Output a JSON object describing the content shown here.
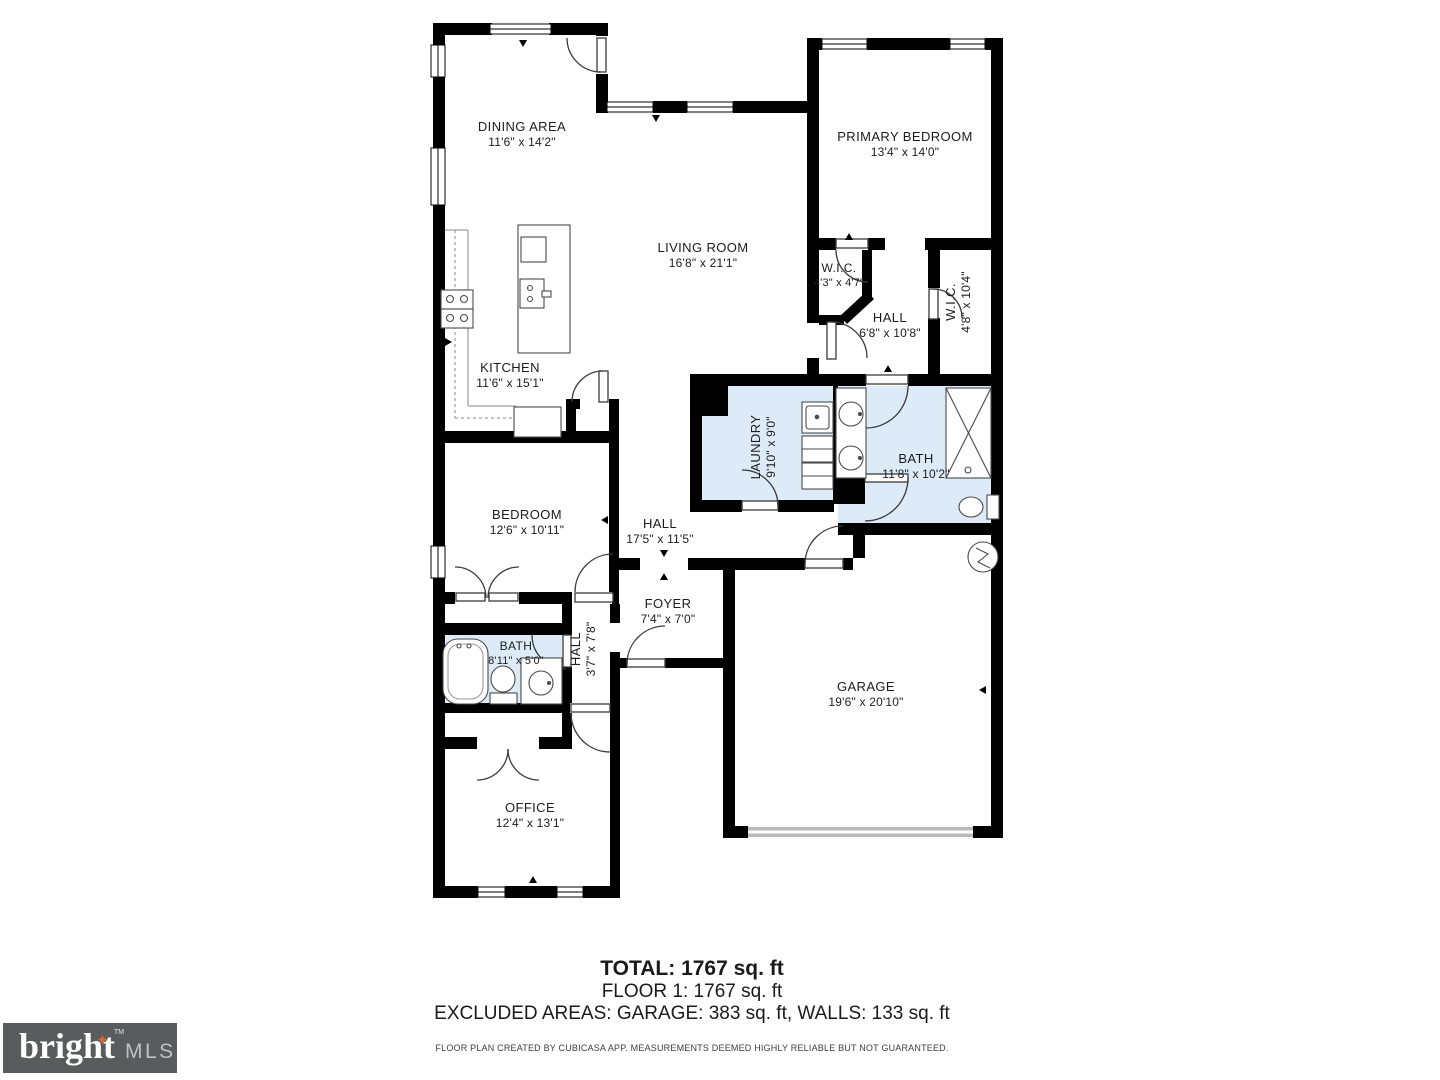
{
  "rooms": {
    "dining": {
      "name": "DINING AREA",
      "dims": "11'6\" x 14'2\""
    },
    "primary": {
      "name": "PRIMARY BEDROOM",
      "dims": "13'4\" x 14'0\""
    },
    "living": {
      "name": "LIVING ROOM",
      "dims": "16'8\" x 21'1\""
    },
    "wic1": {
      "name": "W.I.C.",
      "dims": "4'3\" x 4'7\""
    },
    "hall1": {
      "name": "HALL",
      "dims": "6'8\" x 10'8\""
    },
    "wic2": {
      "name": "W.I.C.",
      "dims": "4'8\" x 10'4\""
    },
    "kitchen": {
      "name": "KITCHEN",
      "dims": "11'6\" x 15'1\""
    },
    "laundry": {
      "name": "LAUNDRY",
      "dims": "9'10\" x 9'0\""
    },
    "bath1": {
      "name": "BATH",
      "dims": "11'8\" x 10'2\""
    },
    "bedroom": {
      "name": "BEDROOM",
      "dims": "12'6\" x 10'11\""
    },
    "hall2": {
      "name": "HALL",
      "dims": "17'5\" x 11'5\""
    },
    "foyer": {
      "name": "FOYER",
      "dims": "7'4\" x 7'0\""
    },
    "bath2": {
      "name": "BATH",
      "dims": "8'11\" x 5'0\""
    },
    "hall3": {
      "name": "HALL",
      "dims": "3'7\" x 7'8\""
    },
    "garage": {
      "name": "GARAGE",
      "dims": "19'6\" x 20'10\""
    },
    "office": {
      "name": "OFFICE",
      "dims": "12'4\" x 13'1\""
    }
  },
  "summary": {
    "total": "TOTAL: 1767 sq. ft",
    "floor": "FLOOR 1: 1767 sq. ft",
    "excluded": "EXCLUDED AREAS: GARAGE: 383 sq. ft, WALLS: 133 sq. ft",
    "disclaimer": "FLOOR PLAN CREATED BY CUBICASA APP. MEASUREMENTS DEEMED HIGHLY RELIABLE BUT NOT GUARANTEED."
  },
  "logo": {
    "brand": "bright",
    "suffix": "MLS",
    "trademark": "TM",
    "star": "✦"
  },
  "colors": {
    "wet_room_fill": "#dcebf7",
    "wall": "#000000",
    "accent_star": "#e8622d"
  }
}
